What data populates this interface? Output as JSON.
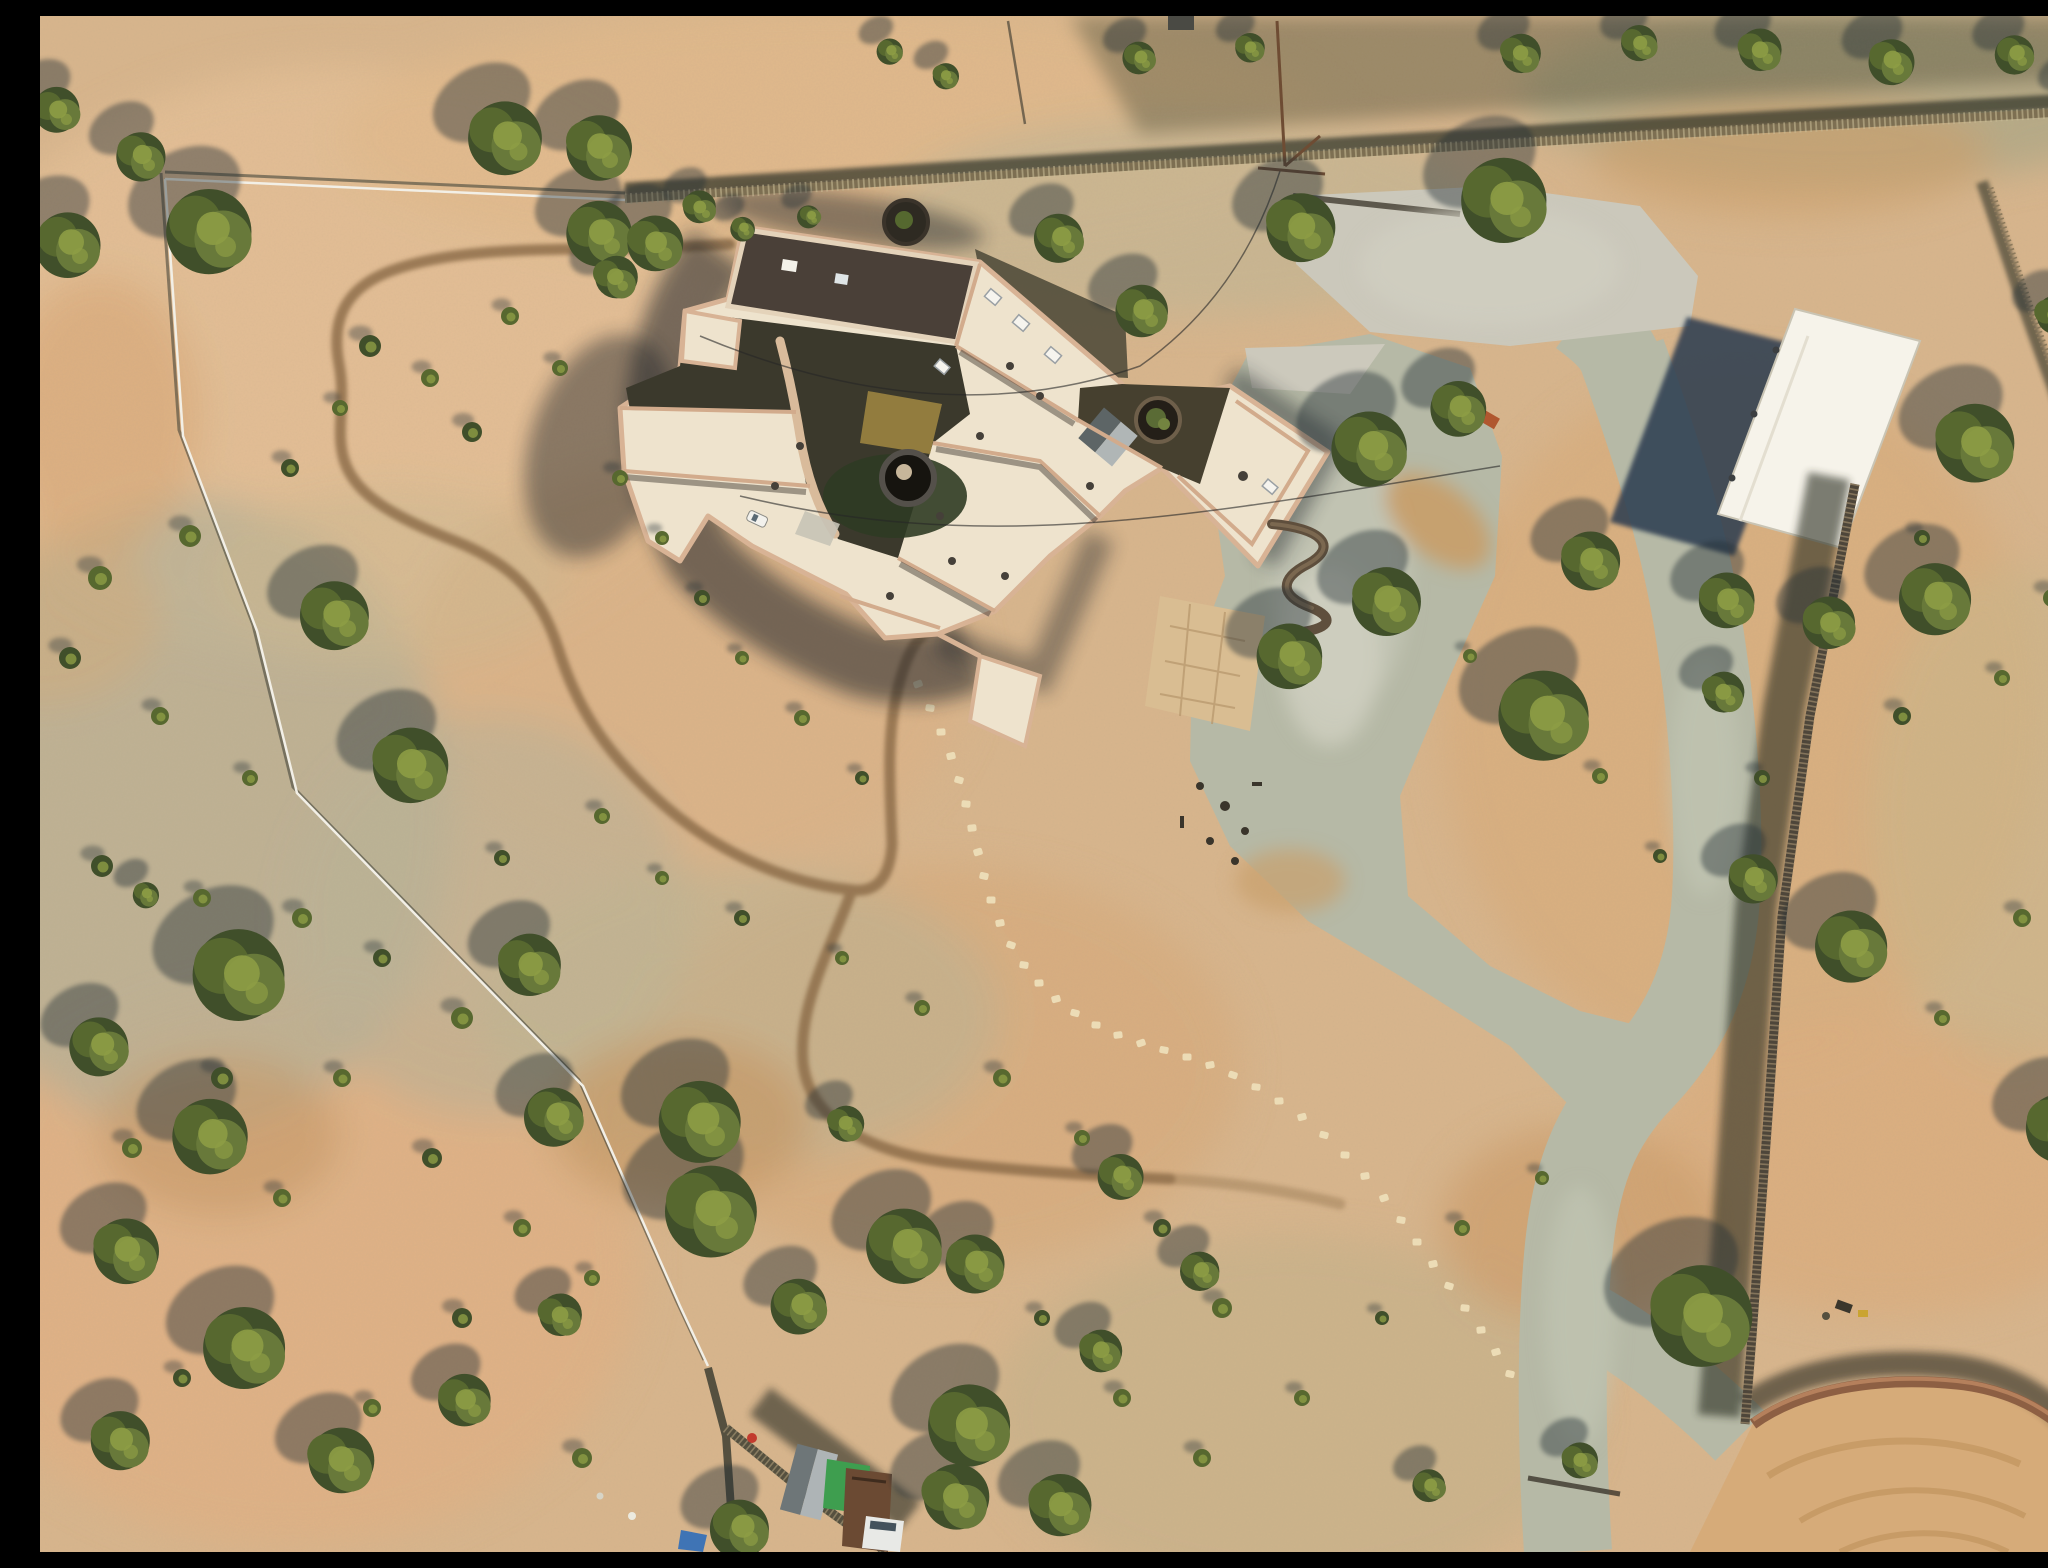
{
  "meta": {
    "type": "aerial-drone-photograph",
    "description": "Overhead drone photo of a pueblo-style adobe home on fenced desert acreage with gravel driveway, detached carport, juniper trees, dirt riding track and neighboring parcels."
  },
  "palette": {
    "sand_base": "#d9b68d",
    "sand_light": "#e6c197",
    "sand_pink": "#e0b285",
    "dirt_orange": "#c89a67",
    "scrub_gray": "#b6b097",
    "scrub_green": "#bab298",
    "gravel": "#b6b9a6",
    "gravel_light": "#cdcdbf",
    "track_brown": "#8a6a47",
    "tree_dark": "#404f2a",
    "tree_mid": "#57682f",
    "tree_mid2": "#68793a",
    "tree_light": "#8d9c45",
    "shadow": "#242f34",
    "house_cream": "#eee3cd",
    "parapet_pink": "#d8b395",
    "roof_dark": "#4a4038",
    "courtyard_dark": "#3b392c",
    "lawn_green": "#2f3b24",
    "carport_white": "#f6f3ea",
    "carport_shadow": "#2a3b50",
    "fence_stick": "#7d6f52",
    "fence_wire": "#f2efe6",
    "adobe_wall": "#8d5f43",
    "arena_dirt": "#d6ab79",
    "stone": "#ecdcb6",
    "tarp_green": "#3e9e4f",
    "tarp_blue": "#3f74b5"
  },
  "scene": {
    "trees": [
      [
        18,
        95,
        28
      ],
      [
        28,
        228,
        40
      ],
      [
        100,
        140,
        30
      ],
      [
        170,
        215,
        52
      ],
      [
        465,
        122,
        45
      ],
      [
        558,
        132,
        40
      ],
      [
        560,
        218,
        40
      ],
      [
        615,
        228,
        34
      ],
      [
        575,
        262,
        26
      ],
      [
        660,
        192,
        20
      ],
      [
        702,
        212,
        15
      ],
      [
        770,
        200,
        14
      ],
      [
        850,
        35,
        16
      ],
      [
        905,
        60,
        16
      ],
      [
        1100,
        42,
        20
      ],
      [
        1210,
        32,
        18
      ],
      [
        1480,
        38,
        24
      ],
      [
        1600,
        28,
        22
      ],
      [
        1720,
        35,
        26
      ],
      [
        1850,
        45,
        28
      ],
      [
        1975,
        38,
        24
      ],
      [
        2035,
        80,
        20
      ],
      [
        1020,
        222,
        30
      ],
      [
        1102,
        295,
        32
      ],
      [
        1260,
        212,
        42
      ],
      [
        1465,
        185,
        52
      ],
      [
        1935,
        428,
        48
      ],
      [
        2015,
        300,
        24
      ],
      [
        1330,
        432,
        46
      ],
      [
        1418,
        392,
        34
      ],
      [
        1345,
        585,
        42
      ],
      [
        1250,
        640,
        40
      ],
      [
        1550,
        545,
        36
      ],
      [
        1505,
        700,
        55
      ],
      [
        1687,
        585,
        34
      ],
      [
        1683,
        677,
        25
      ],
      [
        1790,
        608,
        32
      ],
      [
        1895,
        582,
        44
      ],
      [
        1712,
        862,
        30
      ],
      [
        1812,
        930,
        44
      ],
      [
        2020,
        1112,
        42
      ],
      [
        1660,
        1300,
        62
      ],
      [
        295,
        600,
        42
      ],
      [
        370,
        750,
        46
      ],
      [
        200,
        960,
        56
      ],
      [
        490,
        950,
        38
      ],
      [
        105,
        878,
        16
      ],
      [
        60,
        1030,
        36
      ],
      [
        170,
        1120,
        46
      ],
      [
        85,
        1235,
        40
      ],
      [
        205,
        1332,
        50
      ],
      [
        80,
        1425,
        36
      ],
      [
        300,
        1445,
        40
      ],
      [
        425,
        1385,
        32
      ],
      [
        520,
        1300,
        26
      ],
      [
        515,
        1100,
        36
      ],
      [
        660,
        1105,
        50
      ],
      [
        670,
        1195,
        56
      ],
      [
        865,
        1230,
        46
      ],
      [
        935,
        1248,
        36
      ],
      [
        805,
        1108,
        22
      ],
      [
        930,
        1410,
        50
      ],
      [
        1020,
        1490,
        38
      ],
      [
        915,
        1482,
        40
      ],
      [
        700,
        1512,
        36
      ],
      [
        1080,
        1160,
        28
      ],
      [
        760,
        1290,
        34
      ],
      [
        1160,
        1255,
        24
      ],
      [
        1060,
        1335,
        26
      ],
      [
        1390,
        1470,
        20
      ],
      [
        1540,
        1445,
        22
      ]
    ],
    "bushes": [
      [
        330,
        330,
        11
      ],
      [
        390,
        362,
        9
      ],
      [
        300,
        392,
        8
      ],
      [
        432,
        416,
        10
      ],
      [
        470,
        300,
        9
      ],
      [
        520,
        352,
        8
      ],
      [
        250,
        452,
        9
      ],
      [
        150,
        520,
        11
      ],
      [
        60,
        562,
        12
      ],
      [
        30,
        642,
        11
      ],
      [
        120,
        700,
        9
      ],
      [
        210,
        762,
        8
      ],
      [
        62,
        850,
        11
      ],
      [
        162,
        882,
        9
      ],
      [
        262,
        902,
        10
      ],
      [
        342,
        942,
        9
      ],
      [
        422,
        1002,
        11
      ],
      [
        302,
        1062,
        9
      ],
      [
        182,
        1062,
        11
      ],
      [
        92,
        1132,
        10
      ],
      [
        242,
        1182,
        9
      ],
      [
        392,
        1142,
        10
      ],
      [
        482,
        1212,
        9
      ],
      [
        552,
        1262,
        8
      ],
      [
        422,
        1302,
        10
      ],
      [
        332,
        1392,
        9
      ],
      [
        542,
        1442,
        10
      ],
      [
        142,
        1362,
        9
      ],
      [
        580,
        462,
        8
      ],
      [
        622,
        522,
        7
      ],
      [
        662,
        582,
        8
      ],
      [
        702,
        642,
        7
      ],
      [
        762,
        702,
        8
      ],
      [
        822,
        762,
        7
      ],
      [
        882,
        992,
        8
      ],
      [
        802,
        942,
        7
      ],
      [
        702,
        902,
        8
      ],
      [
        622,
        862,
        7
      ],
      [
        562,
        800,
        8
      ],
      [
        462,
        842,
        8
      ],
      [
        962,
        1062,
        9
      ],
      [
        1042,
        1122,
        8
      ],
      [
        1122,
        1212,
        9
      ],
      [
        1182,
        1292,
        10
      ],
      [
        1082,
        1382,
        9
      ],
      [
        1002,
        1302,
        8
      ],
      [
        1162,
        1442,
        9
      ],
      [
        1262,
        1382,
        8
      ],
      [
        1342,
        1302,
        7
      ],
      [
        1422,
        1212,
        8
      ],
      [
        1502,
        1162,
        7
      ],
      [
        1862,
        700,
        9
      ],
      [
        1962,
        662,
        8
      ],
      [
        2012,
        582,
        9
      ],
      [
        1882,
        522,
        8
      ],
      [
        1982,
        902,
        9
      ],
      [
        1902,
        1002,
        8
      ],
      [
        1722,
        762,
        8
      ],
      [
        1430,
        640,
        7
      ],
      [
        1560,
        760,
        8
      ],
      [
        1620,
        840,
        7
      ]
    ],
    "stepping_stones": [
      [
        878,
        668
      ],
      [
        890,
        692
      ],
      [
        901,
        716
      ],
      [
        911,
        740
      ],
      [
        919,
        764
      ],
      [
        926,
        788
      ],
      [
        932,
        812
      ],
      [
        938,
        836
      ],
      [
        944,
        860
      ],
      [
        951,
        884
      ],
      [
        960,
        907
      ],
      [
        971,
        929
      ],
      [
        984,
        949
      ],
      [
        999,
        967
      ],
      [
        1016,
        983
      ],
      [
        1035,
        997
      ],
      [
        1056,
        1009
      ],
      [
        1078,
        1019
      ],
      [
        1101,
        1027
      ],
      [
        1124,
        1034
      ],
      [
        1147,
        1041
      ],
      [
        1170,
        1049
      ],
      [
        1193,
        1059
      ],
      [
        1216,
        1071
      ],
      [
        1239,
        1085
      ],
      [
        1262,
        1101
      ],
      [
        1284,
        1119
      ],
      [
        1305,
        1139
      ],
      [
        1325,
        1160
      ],
      [
        1344,
        1182
      ],
      [
        1361,
        1204
      ],
      [
        1377,
        1226
      ],
      [
        1393,
        1248
      ],
      [
        1409,
        1270
      ],
      [
        1425,
        1292
      ],
      [
        1441,
        1314
      ],
      [
        1456,
        1336
      ],
      [
        1470,
        1358
      ]
    ]
  }
}
